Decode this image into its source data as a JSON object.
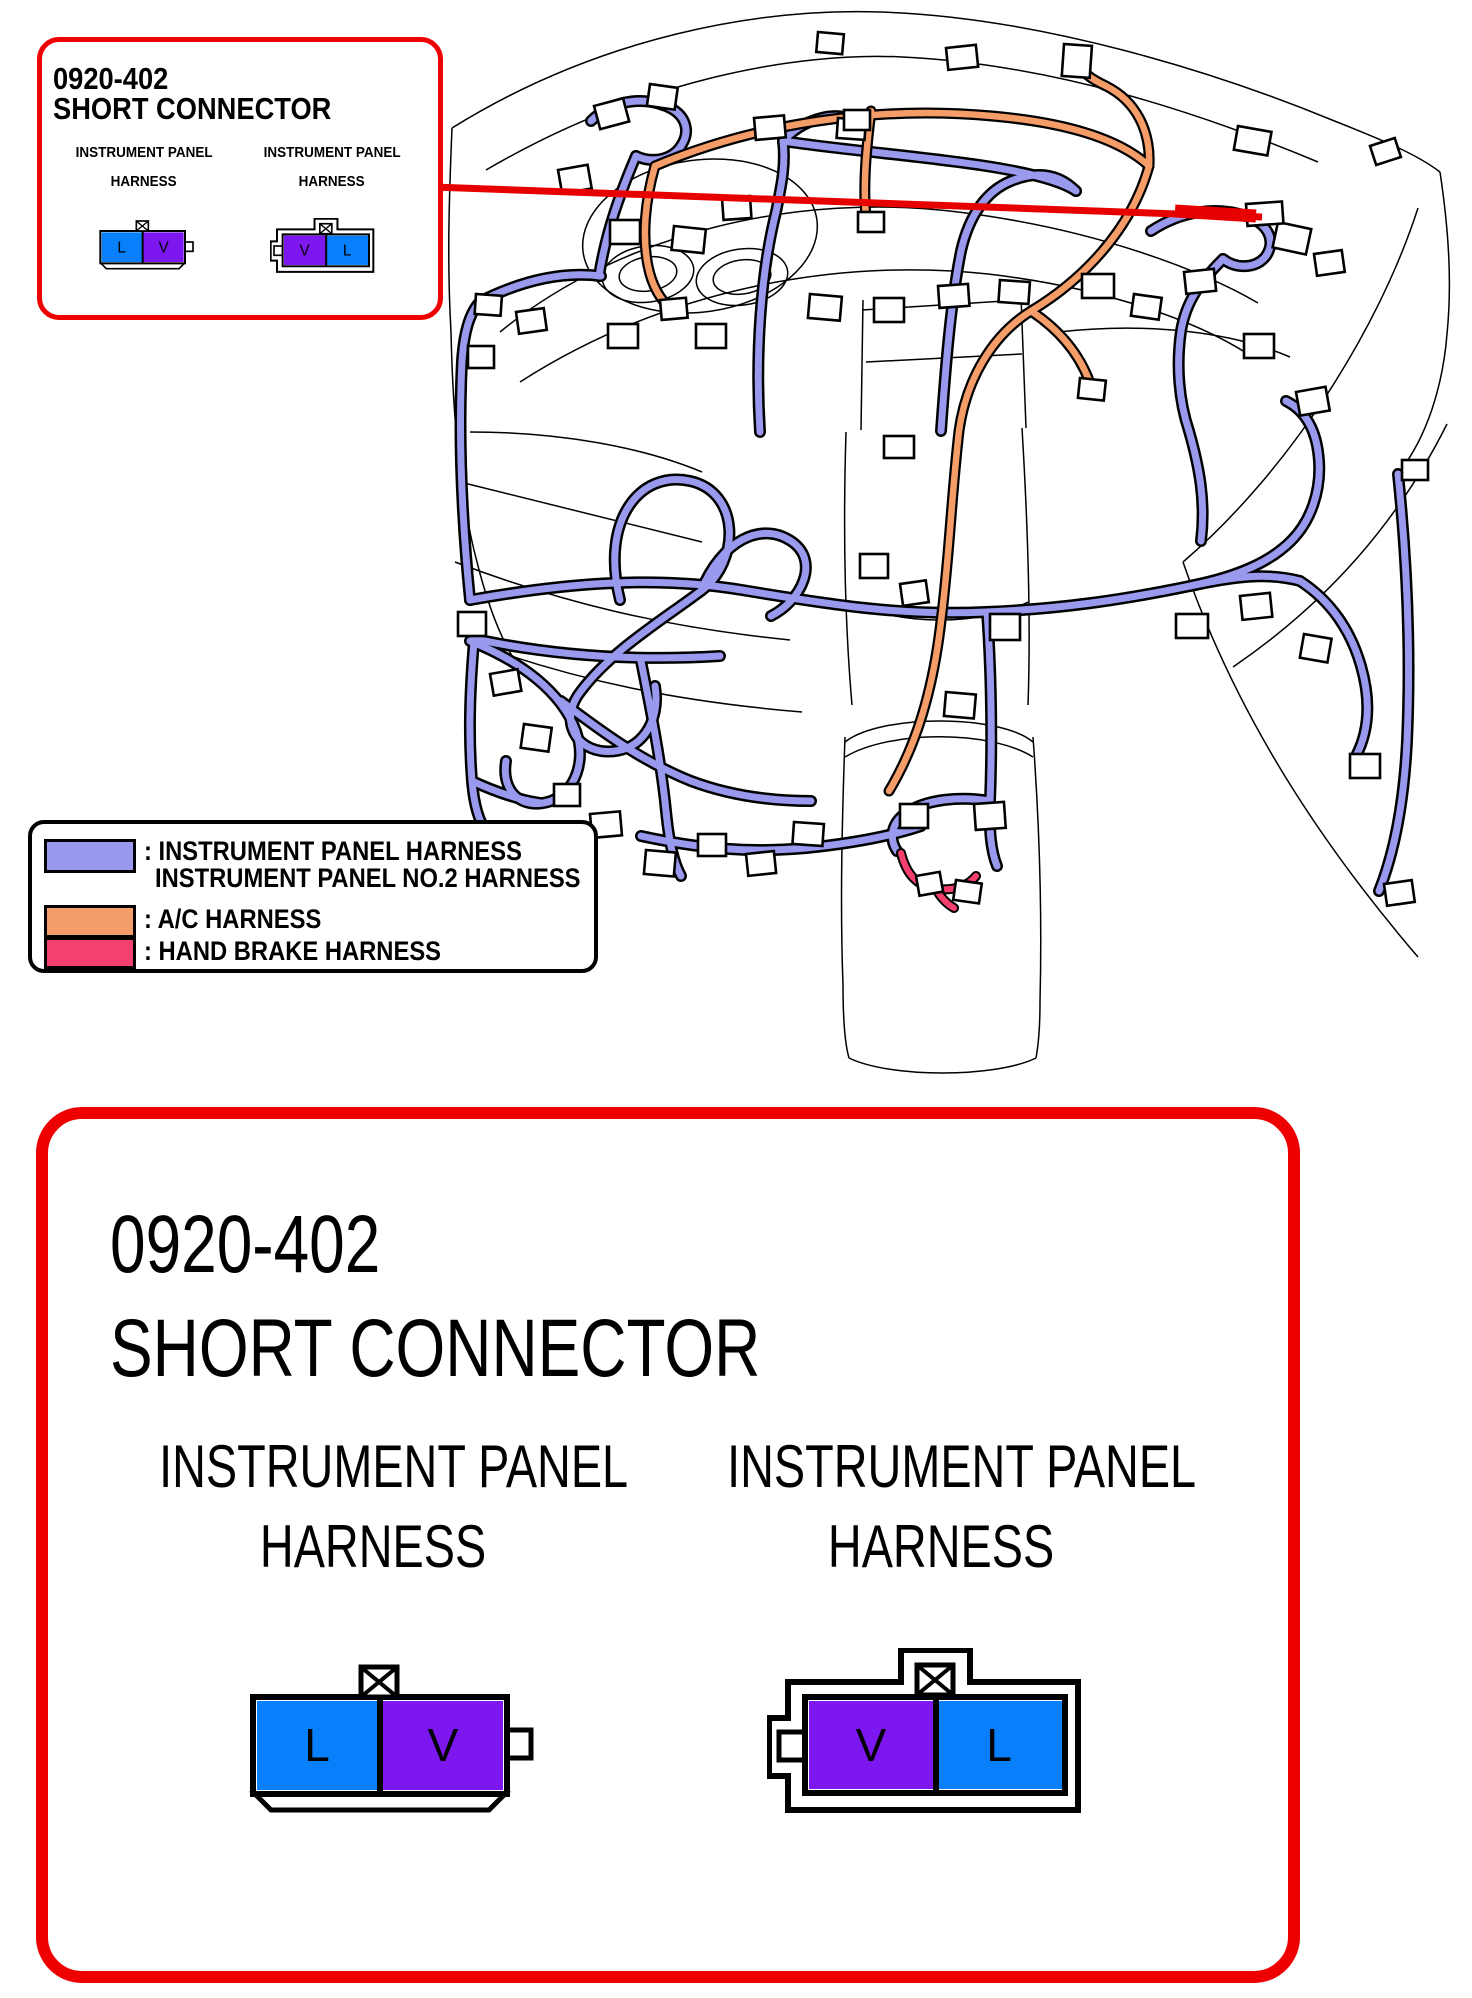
{
  "colors": {
    "callout_border": "#EE0000",
    "leader_red": "#E60000",
    "harness_purple": "#9999EE",
    "harness_orange": "#F59D68",
    "harness_pink": "#F4406E",
    "terminal_blue": "#0880FC",
    "terminal_purple": "#7D17F0"
  },
  "callout": {
    "code": "0920-402",
    "title": "SHORT CONNECTOR",
    "columns": [
      {
        "label_line1": "INSTRUMENT PANEL",
        "label_line2": "HARNESS",
        "terminals": [
          "L",
          "V"
        ]
      },
      {
        "label_line1": "INSTRUMENT PANEL",
        "label_line2": "HARNESS",
        "terminals": [
          "V",
          "L"
        ]
      }
    ]
  },
  "legend": {
    "items": [
      {
        "swatch_color": "#9999EE",
        "line1": ": INSTRUMENT PANEL HARNESS",
        "line2": "INSTRUMENT PANEL NO.2 HARNESS"
      },
      {
        "swatch_color": "#F59D68",
        "line1": ": A/C HARNESS"
      },
      {
        "swatch_color": "#F4406E",
        "line1": ": HAND BRAKE HARNESS"
      }
    ]
  },
  "detail": {
    "code": "0920-402",
    "title": "SHORT CONNECTOR",
    "columns": [
      {
        "label_line1": "INSTRUMENT PANEL",
        "label_line2": "HARNESS",
        "terminals": [
          "L",
          "V"
        ]
      },
      {
        "label_line1": "INSTRUMENT PANEL",
        "label_line2": "HARNESS",
        "terminals": [
          "V",
          "L"
        ]
      }
    ]
  }
}
